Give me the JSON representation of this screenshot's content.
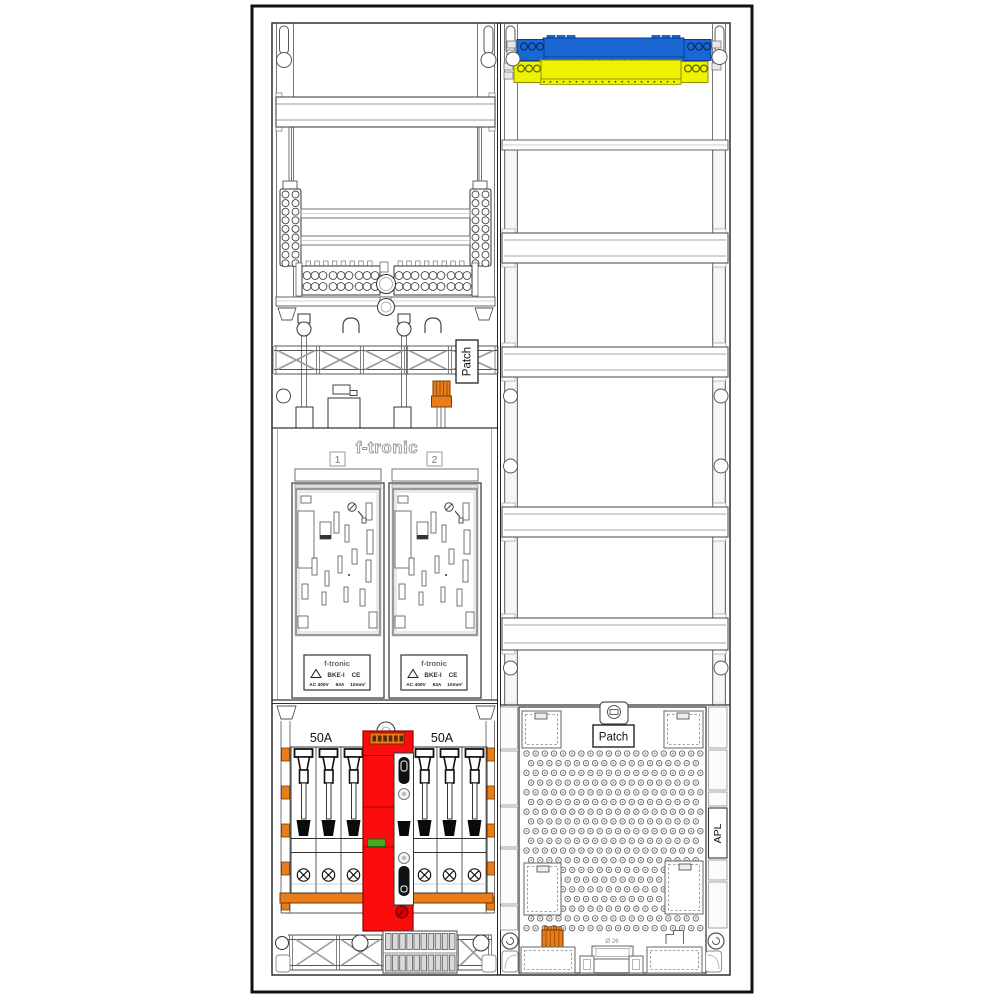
{
  "labels": {
    "patch_left": "Patch",
    "patch_right": "Patch",
    "apl": "APL",
    "brand": "f-tronic",
    "meter_field_1": "1",
    "meter_field_2": "2",
    "rating_left": "50A",
    "rating_right": "50A",
    "gland_diameter": "Ø 26"
  },
  "meter_plate": {
    "brand": "f-tronic",
    "model": "BKE-I",
    "ce_mark": "CE",
    "voltage": "AC 400V",
    "current": "63A",
    "wire_size": "10mm²"
  },
  "colors": {
    "busbar_n_blue": "#1a66d2",
    "busbar_pe_yellow": "#eef200",
    "terminal_orange": "#e87d1a",
    "device_red": "#fb0d0d",
    "led_green": "#46a926"
  }
}
